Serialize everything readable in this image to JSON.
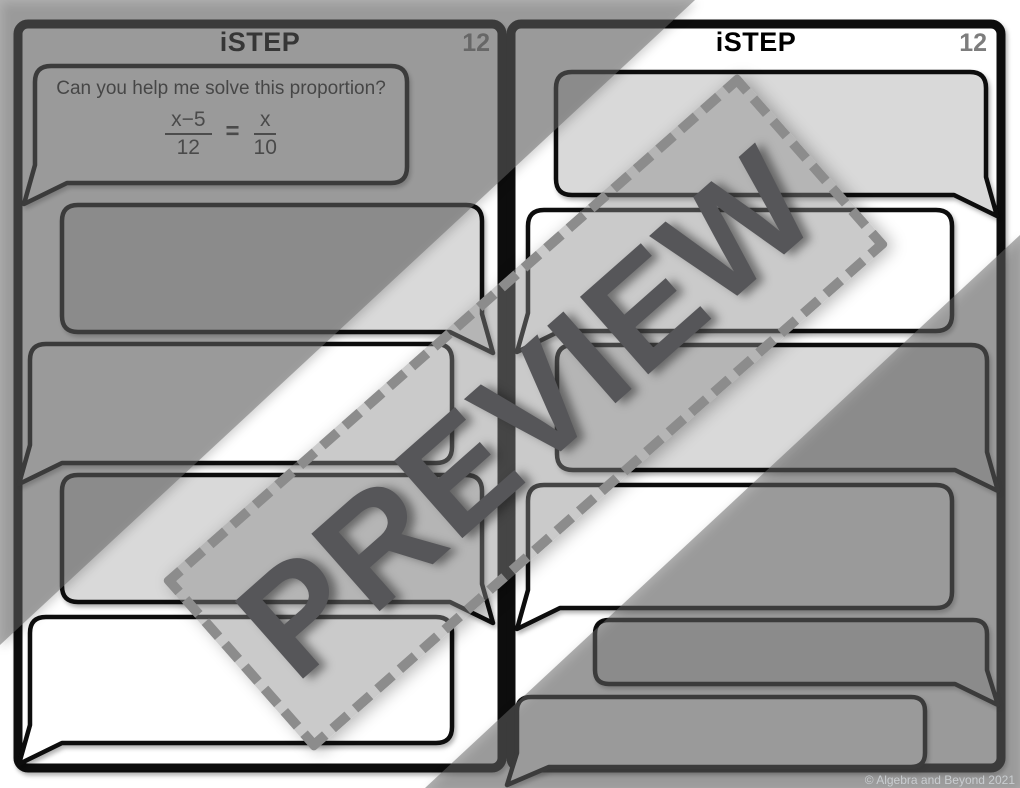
{
  "left_panel": {
    "title": "iSTEP",
    "step_number": "12",
    "question": {
      "text": "Can you help me solve this proportion?",
      "equation": {
        "numerator_1": "x−5",
        "denominator_1": "12",
        "equals": "=",
        "numerator_2": "x",
        "denominator_2": "10"
      }
    }
  },
  "right_panel": {
    "title": "iSTEP",
    "step_number": "12"
  },
  "watermark": {
    "text": "PREVIEW"
  },
  "footer": {
    "copyright": "© Algebra and Beyond 2021"
  },
  "colors": {
    "page_bg": "#ffffff",
    "bubble_gray": "#d9d9d9",
    "bubble_white": "#ffffff",
    "ink_black": "#0a0a0a",
    "step_number_gray": "#7d7d7d",
    "overlay_gray": "rgba(104,104,104,0.52)",
    "watermark_fill": "rgba(138,138,138,0.45)",
    "watermark_border": "#8c8c8c",
    "watermark_text": "#565659",
    "copyright_gray": "#c9cdd0"
  }
}
